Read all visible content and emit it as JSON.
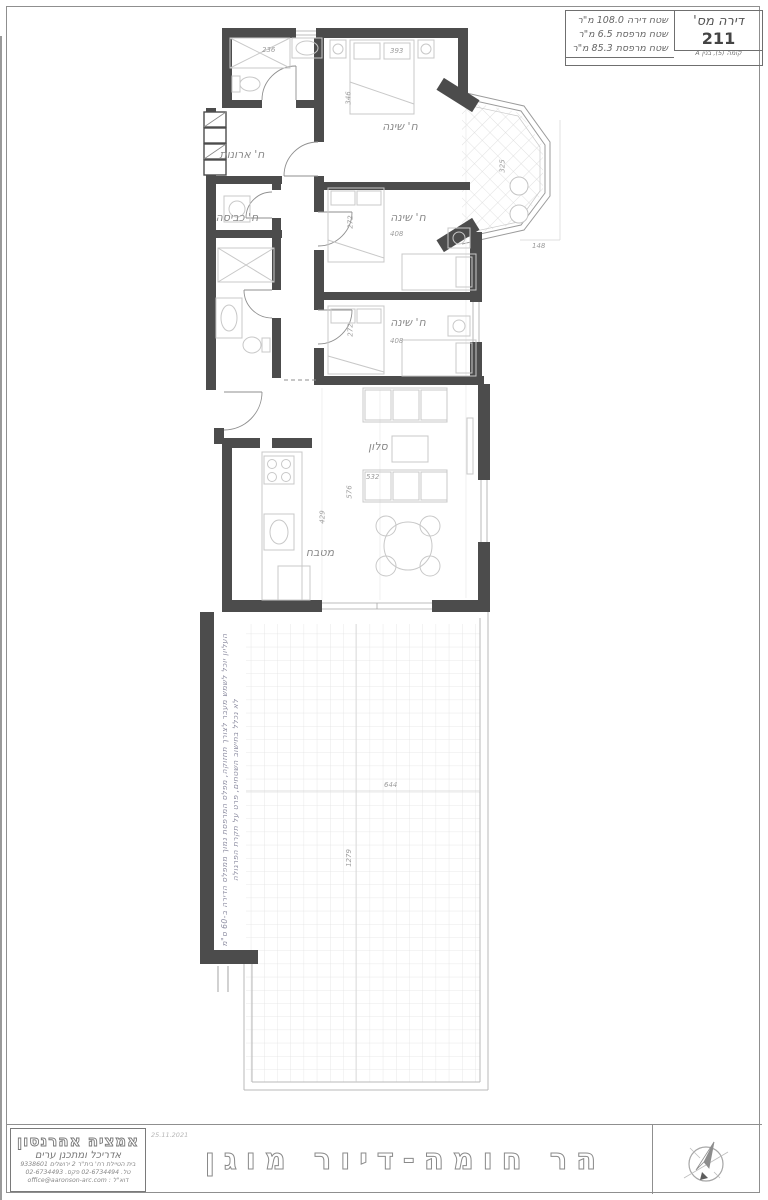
{
  "title_block": {
    "apt_label": "דירה מס'",
    "apt_number": "211",
    "floor_line": "קומה (5), בנין A",
    "area_line_1": "שטח דירה 108.0 מ\"ר",
    "area_line_2": "שטח מרפסת 6.5 מ\"ר",
    "area_line_3": "שטח מרפסת 85.3 מ\"ר"
  },
  "rooms": {
    "bedroom1": "ח' שינה",
    "bedroom2": "ח' שינה",
    "bedroom3": "ח' שינה",
    "closets": "ח' ארונות",
    "laundry": "ח' כביסה",
    "living": "סלון",
    "kitchen": "מטבח"
  },
  "dimensions": {
    "shower": "236",
    "bed1_width": "393",
    "bed1_depth": "346",
    "bay_width": "325",
    "bay_depth": "148",
    "bed2_depth": "272",
    "bed2_width": "408",
    "bed3_depth": "272",
    "bed3_width": "408",
    "living_width": "532",
    "living_depth": "576",
    "kitchen_depth": "429",
    "terrace_width": "644",
    "terrace_length": "1279"
  },
  "terrace_note": {
    "line1": "העליון יוכל לשמש מעבר לצורך תחזוקה, מפלס המרפסת נמוך ממפלס הדירה ב-60 ס\"מ",
    "line2": "לא נכלל בחישוב השטחים, פרט על תקרת הפרגולה"
  },
  "footer": {
    "architect_name": "אמציה אהרנסון",
    "architect_role": "אדריכל ומתכנן ערים",
    "architect_address": "בית הטיילת רח' בית\"ר 2 ירושלים 9338601",
    "architect_phone": "טל. 02-6734494 פקס. 02-6734493",
    "architect_email": "דוא\"ל : office@aaronson-arc.com",
    "date": "25.11.2021",
    "project_title": "הר חומה-דיור מוגן"
  },
  "colors": {
    "wall": "#4c4c4c",
    "furniture_line": "#c8c8c8",
    "label": "#8a8a8a",
    "tile_line": "#e2e2e2"
  }
}
